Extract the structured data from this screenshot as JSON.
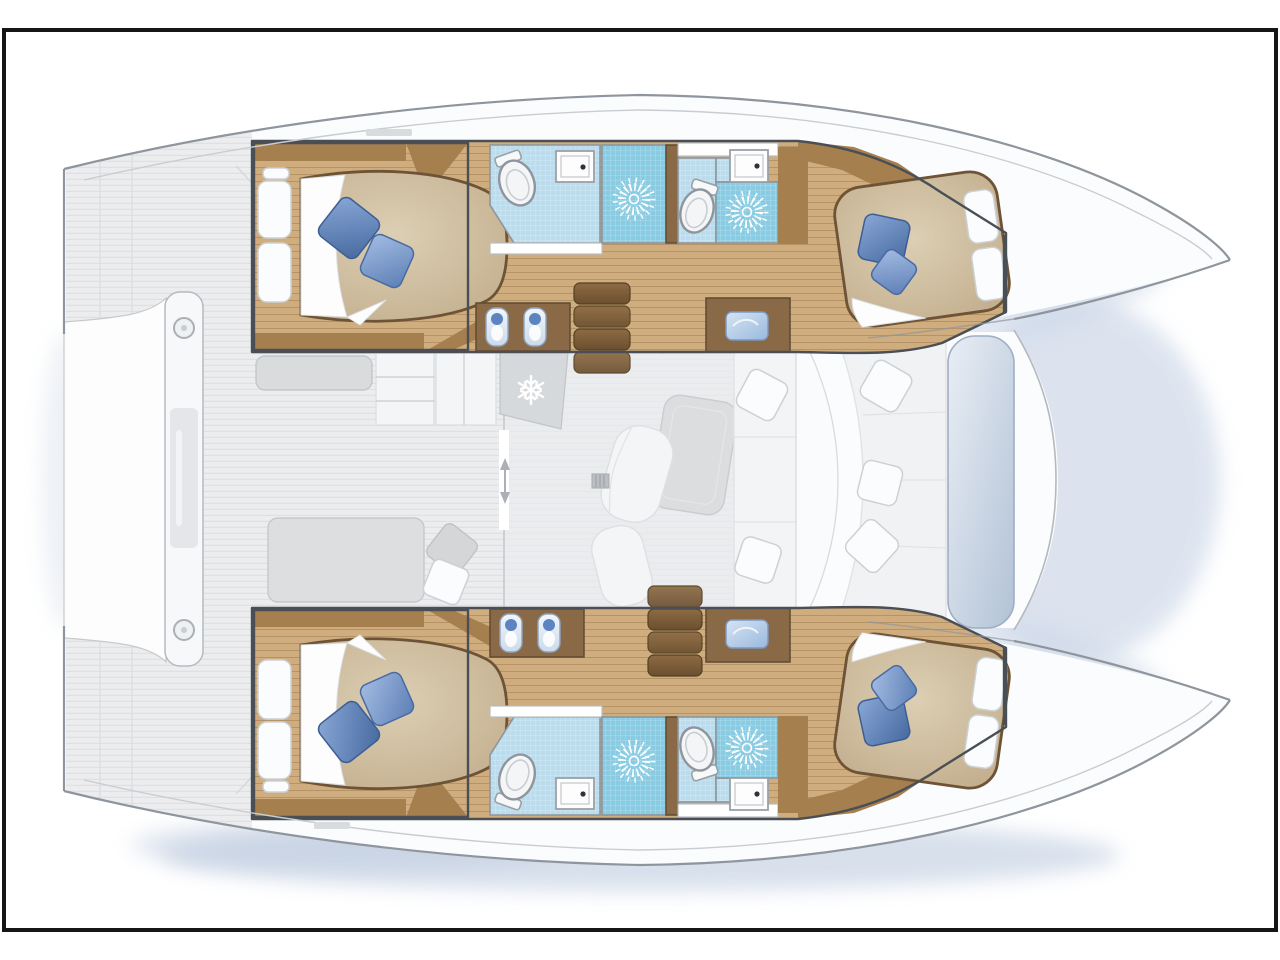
{
  "document": {
    "kind": "catamaran yacht accommodation plan",
    "view": "top-down deck and interior layout drawing",
    "visible_text": "none (only faint illegible dimension marks)"
  },
  "icons": {
    "snowflake": "refrigeration unit marker",
    "shower_rose": "shower head starburst marker",
    "door_arrows": "sliding-door direction marker"
  },
  "palette": {
    "frame": "#161616",
    "background": "#ffffff",
    "hull_fill": "#fbfcfd",
    "hull_outline": "#8e959c",
    "toe_rail": "#c9cdd1",
    "deck_base": "#ecedef",
    "deck_line": "#dddfe2",
    "wall": "#4a4f55",
    "wood_floor": "#d0ad7e",
    "wood_line": "#a8855a",
    "wood_dark": "#8a6947",
    "headboard": "#a67f4f",
    "tile_blue": "#badcec",
    "shower_blue": "#88cbe2",
    "mattress_light": "#dccfb4",
    "mattress_dark": "#c2ad8c",
    "mattress_edge": "#6e5436",
    "pillow_blue": "#4e73ad",
    "pillow_blue_light": "#8fadda",
    "salon_floor": "#e9ebed",
    "furniture_white": "#f4f5f7",
    "furniture_gray": "#d9dbdd",
    "steps_light": "#8d6b44",
    "steps_dark": "#6b4f30",
    "pad_light": "#e9eef5",
    "pad_dark": "#b2c2d6",
    "water_shadow": "#aebfd8"
  },
  "floorplan": {
    "layout": "4 double cabins / 4 heads, bows to the right, transoms to the left",
    "hulls": [
      {
        "id": "port-hull",
        "position": "top",
        "rooms": [
          "stern double cabin (island berth, 2 blue + 3 white pillows)",
          "head with toilet, washbasin and shower rose",
          "second head with toilet, washbasin and shower rose",
          "bow double cabin (berth, 2 blue + 2 white pillows)"
        ],
        "other": [
          "twin-sink vanity",
          "companionway steps",
          "chart desk with blue basin"
        ]
      },
      {
        "id": "starboard-hull",
        "position": "bottom",
        "rooms": [
          "stern double cabin (island berth, 2 blue + 3 white pillows)",
          "head with toilet, washbasin and shower rose",
          "second head with toilet, washbasin and shower rose",
          "bow double cabin (berth, 2 blue + 2 white pillows)"
        ],
        "other": [
          "twin-sink vanity",
          "companionway steps",
          "chart desk with blue basin"
        ]
      }
    ],
    "saloon": {
      "items": [
        "galley units",
        "refrigerator (snowflake panel)",
        "dining table",
        "chaise longue",
        "sofa with seams",
        "white and gray scatter cushions",
        "floor vent",
        "sliding door with arrows"
      ]
    },
    "aft_deck": {
      "items": [
        "striped teak deck",
        "transom platform",
        "crossbeam with two deck fittings",
        "bench",
        "daybed with gray and white cushions"
      ]
    },
    "forward_cockpit": {
      "items": [
        "curved bench seat",
        "three white cushions",
        "blue-gray lounge pad"
      ]
    },
    "fixture_counts": {
      "double_berths": 4,
      "toilets": 4,
      "shower_roses": 4,
      "washbasin_counters": 4,
      "vanity_sinks": 4,
      "step_flights": 2,
      "crossbeam_fittings": 2
    }
  }
}
